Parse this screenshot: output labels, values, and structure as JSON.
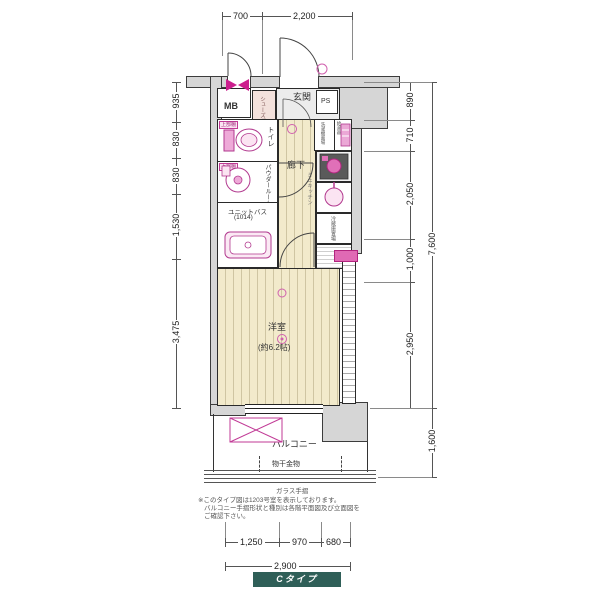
{
  "dims": {
    "top": [
      "700",
      "2,200"
    ],
    "left": [
      "935",
      "830",
      "830",
      "1,530",
      "3,475"
    ],
    "right": [
      "890",
      "710",
      "2,050",
      "1,000",
      "2,950"
    ],
    "right_total": "7,600",
    "right_balcony": "1,600",
    "bottom": [
      "1,250",
      "970",
      "680"
    ],
    "bottom_total": "2,900"
  },
  "rooms": {
    "mb": "MB",
    "ps": "PS",
    "genkan": "玄関",
    "shoebox": "シューズボックス",
    "toilet": "トイレ",
    "shelf": "上部棚",
    "powder": "パウダールーム",
    "unitbath": "ユニットバス",
    "unitbath_size": "(1014)",
    "hallway": "廊下",
    "kitchen": "ミニキッチン",
    "washer": "洗濯機置場",
    "heater": "給湯器",
    "fridge": "冷蔵庫置場",
    "room": "洋室",
    "room_size": "(約6.2帖)",
    "balcony": "バルコニー",
    "drying": "物干金物",
    "railing": "ガラス手摺"
  },
  "notes": [
    "※このタイプ図は1203号室を表示しております。",
    "バルコニー手摺形状と種別は各階平面図及び立面図を",
    "ご確認下さい。"
  ],
  "footer": {
    "type_label": "Cタイプ"
  },
  "colors": {
    "accent_pink": "#c13a96",
    "wall_gray": "#d6d6d6",
    "wood_floor": "#f2eacb",
    "badge_teal": "#2f5f58"
  }
}
